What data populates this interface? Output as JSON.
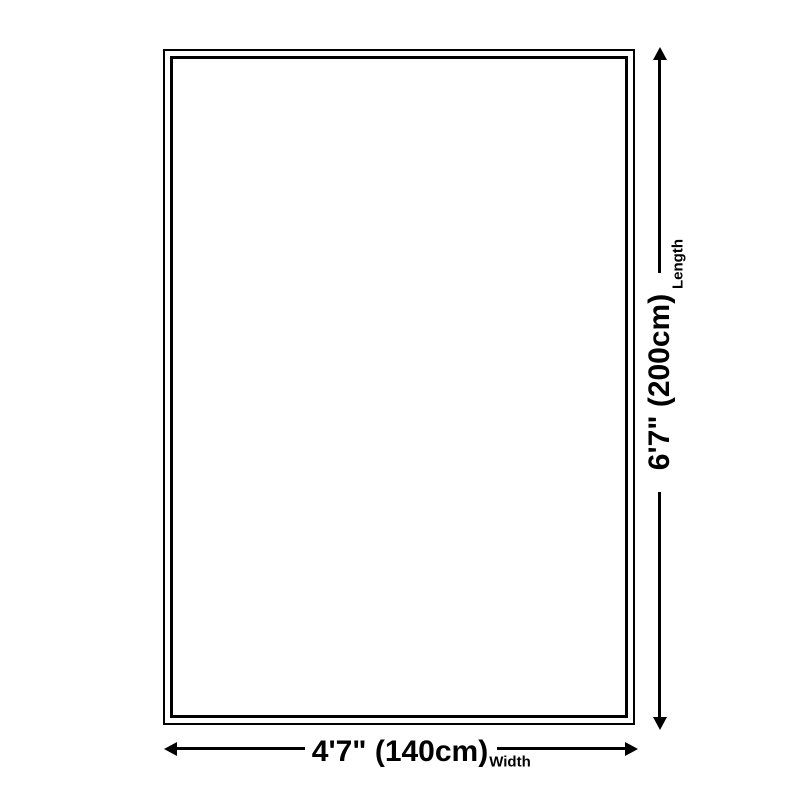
{
  "diagram": {
    "type": "product-dimension-diagram",
    "length": {
      "value": "6'7\" (200cm)",
      "label": "Length"
    },
    "width": {
      "value": "4'7\" (140cm)",
      "label": "Width"
    },
    "colors": {
      "stroke": "#000000",
      "background": "#ffffff"
    }
  }
}
